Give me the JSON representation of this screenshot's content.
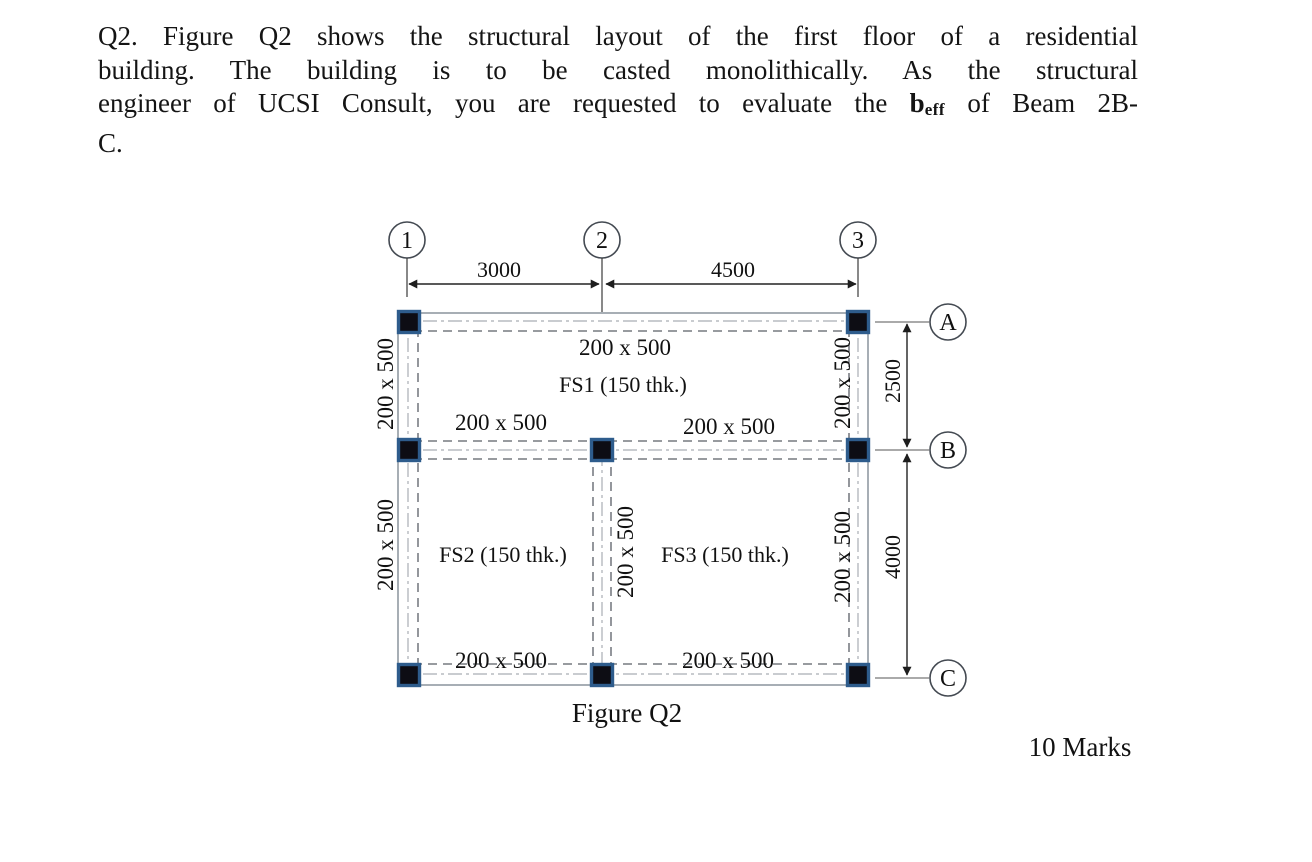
{
  "question": {
    "line1": "Q2. Figure Q2 shows the structural layout of the first floor of a residential",
    "line2": "building. The building is to be casted monolithically. As the structural",
    "line3_pre": "engineer of UCSI Consult, you are requested to evaluate the ",
    "beff_base": "b",
    "beff_sub": "eff",
    "line3_post": " of Beam 2B-",
    "line4": "C."
  },
  "figure": {
    "caption": "Figure Q2",
    "marks": "10 Marks",
    "grid_columns": [
      "1",
      "2",
      "3"
    ],
    "grid_rows": [
      "A",
      "B",
      "C"
    ],
    "dim_horizontal": [
      "3000",
      "4500"
    ],
    "dim_vertical": [
      "2500",
      "4000"
    ],
    "beam_labels": {
      "row_a": "200 x 500",
      "row_b_left": "200 x 500",
      "row_b_right": "200 x 500",
      "row_c_left": "200 x 500",
      "row_c_right": "200 x 500",
      "left_ab": "200 x 500",
      "left_bc": "200 x 500",
      "right_ab": "200 x 500",
      "right_bc": "200 x 500",
      "mid_bc": "200 x 500"
    },
    "slab_labels": {
      "fs1": "FS1 (150 thk.)",
      "fs2": "FS2 (150 thk.)",
      "fs3": "FS3 (150 thk.)"
    }
  },
  "colors": {
    "column_fill": "#0d0d14",
    "column_border": "#2e5c8c"
  }
}
